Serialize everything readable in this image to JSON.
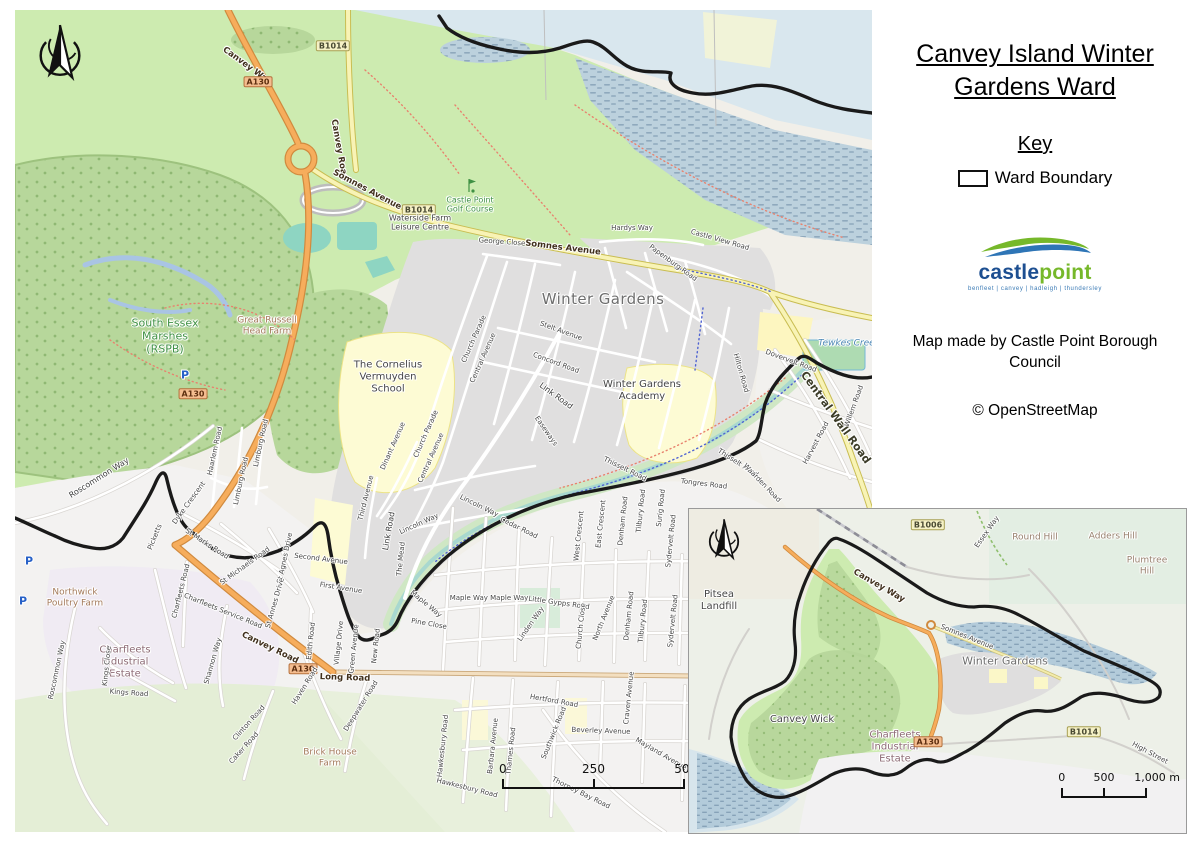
{
  "sidebar": {
    "title": "Canvey Island Winter Gardens Ward",
    "key_heading": "Key",
    "key_items": [
      {
        "symbol": "ward-boundary-rectangle",
        "label": "Ward Boundary"
      }
    ],
    "logo": {
      "brand_blue": "castle",
      "brand_green": "point",
      "tagline": "benfleet | canvey | hadleigh | thundersley",
      "color_blue": "#1d4f91",
      "color_green": "#76b82a"
    },
    "credit": "Map made by Castle Point Borough Council",
    "attribution": "© OpenStreetMap"
  },
  "colors": {
    "ward_boundary": "#1a1a1a",
    "trunk_road": "#f6ad5c",
    "secondary_road": "#f8f3b5",
    "water": "#d9e7ee",
    "greenspace": "#cdebb0",
    "residential": "#e0dfdf",
    "school": "#fdfbd4",
    "leisure": "#8ed5c2"
  },
  "main_map": {
    "north_arrow": "compass-north-arrow",
    "scalebar": {
      "start": "0",
      "mid": "250",
      "end": "500 m"
    },
    "labels": [
      {
        "text": "Canvey Way",
        "x": 232,
        "y": 56,
        "rot": 36,
        "cls": "onroad"
      },
      {
        "text": "A130",
        "x": 243,
        "y": 72,
        "cls": "a-badge"
      },
      {
        "text": "B1014",
        "x": 318,
        "y": 36,
        "cls": "b-badge"
      },
      {
        "text": "Canvey Road",
        "x": 324,
        "y": 140,
        "rot": 80,
        "cls": "onroad"
      },
      {
        "text": "Somnes Avenue",
        "x": 352,
        "y": 180,
        "rot": 28,
        "cls": "onroad"
      },
      {
        "text": "B1014",
        "x": 404,
        "y": 200,
        "cls": "b-badge"
      },
      {
        "text": "Waterside Farm\nLeisure Centre",
        "x": 405,
        "y": 213,
        "cls": "poi"
      },
      {
        "text": "Castle Point\nGolf Course",
        "x": 455,
        "y": 195,
        "cls": "green"
      },
      {
        "text": "Somnes Avenue",
        "x": 548,
        "y": 238,
        "rot": 7,
        "cls": "onroad"
      },
      {
        "text": "Hardys Way",
        "x": 617,
        "y": 218,
        "cls": "street-sm"
      },
      {
        "text": "George Close",
        "x": 487,
        "y": 232,
        "rot": 4,
        "cls": "street-sm"
      },
      {
        "text": "Castle View Road",
        "x": 705,
        "y": 230,
        "rot": 16,
        "cls": "street-sm"
      },
      {
        "text": "Papenburg Road",
        "x": 658,
        "y": 253,
        "rot": 36,
        "cls": "street-sm"
      },
      {
        "text": "Winter Gardens",
        "x": 588,
        "y": 290,
        "cls": "place"
      },
      {
        "text": "South Essex\nMarshes\n(RSPB)",
        "x": 150,
        "y": 327,
        "cls": "green-lg"
      },
      {
        "text": "Great Russell\nHead Farm",
        "x": 252,
        "y": 316,
        "cls": "farm"
      },
      {
        "text": "P",
        "x": 170,
        "y": 366,
        "cls": "parking"
      },
      {
        "text": "A130",
        "x": 178,
        "y": 384,
        "cls": "a-badge"
      },
      {
        "text": "Roscommon Way",
        "x": 84,
        "y": 468,
        "rot": -32,
        "cls": "street"
      },
      {
        "text": "Northwick\nPoultry Farm",
        "x": 60,
        "y": 588,
        "cls": "farm"
      },
      {
        "text": "P",
        "x": 14,
        "y": 552,
        "cls": "parking"
      },
      {
        "text": "P",
        "x": 8,
        "y": 592,
        "cls": "parking"
      },
      {
        "text": "The Cornelius\nVermuyden\nSchool",
        "x": 373,
        "y": 367,
        "cls": "poi-lg"
      },
      {
        "text": "Stelt Avenue",
        "x": 546,
        "y": 321,
        "rot": 20,
        "cls": "street-sm"
      },
      {
        "text": "Concord Road",
        "x": 541,
        "y": 353,
        "rot": 20,
        "cls": "street-sm"
      },
      {
        "text": "Link Road",
        "x": 541,
        "y": 386,
        "rot": 36,
        "cls": "street"
      },
      {
        "text": "Winter Gardens\nAcademy",
        "x": 627,
        "y": 381,
        "cls": "poi-lg"
      },
      {
        "text": "Easeways",
        "x": 531,
        "y": 421,
        "rot": 55,
        "cls": "street-sm"
      },
      {
        "text": "Church Parade",
        "x": 459,
        "y": 329,
        "rot": -66,
        "cls": "street-sm"
      },
      {
        "text": "Central Avenue",
        "x": 468,
        "y": 348,
        "rot": -66,
        "cls": "street-sm"
      },
      {
        "text": "Church Parade",
        "x": 411,
        "y": 424,
        "rot": -66,
        "cls": "street-sm"
      },
      {
        "text": "Central Avenue",
        "x": 416,
        "y": 448,
        "rot": -66,
        "cls": "street-sm"
      },
      {
        "text": "Dinant Avenue",
        "x": 378,
        "y": 436,
        "rot": -66,
        "cls": "street-sm"
      },
      {
        "text": "Third Avenue",
        "x": 351,
        "y": 488,
        "rot": -76,
        "cls": "street-sm"
      },
      {
        "text": "Link Road",
        "x": 374,
        "y": 521,
        "rot": -80,
        "cls": "street"
      },
      {
        "text": "Lincoln Way",
        "x": 404,
        "y": 514,
        "rot": -24,
        "cls": "street-sm"
      },
      {
        "text": "Lincoln Way",
        "x": 464,
        "y": 496,
        "rot": 26,
        "cls": "street-sm"
      },
      {
        "text": "The Mead",
        "x": 386,
        "y": 549,
        "rot": -84,
        "cls": "street-sm"
      },
      {
        "text": "Second Avenue",
        "x": 306,
        "y": 549,
        "rot": 7,
        "cls": "street-sm"
      },
      {
        "text": "First Avenue",
        "x": 326,
        "y": 578,
        "rot": 9,
        "cls": "street-sm"
      },
      {
        "text": "Hilton Road",
        "x": 726,
        "y": 363,
        "rot": 74,
        "cls": "street-sm"
      },
      {
        "text": "Tewkes Creek",
        "x": 834,
        "y": 334,
        "cls": "water"
      },
      {
        "text": "Dovervelt Road",
        "x": 776,
        "y": 351,
        "rot": 20,
        "cls": "street-sm"
      },
      {
        "text": "Central Wall Road",
        "x": 820,
        "y": 408,
        "rot": 54,
        "cls": "onroad-lg"
      },
      {
        "text": "Willem Road",
        "x": 839,
        "y": 396,
        "rot": -70,
        "cls": "street-sm"
      },
      {
        "text": "Harvest Road",
        "x": 801,
        "y": 433,
        "rot": -62,
        "cls": "street-sm"
      },
      {
        "text": "Thisselt Road",
        "x": 610,
        "y": 459,
        "rot": 26,
        "cls": "street-sm"
      },
      {
        "text": "Thisselt Road",
        "x": 723,
        "y": 453,
        "rot": 33,
        "cls": "street-sm"
      },
      {
        "text": "Waarden Road",
        "x": 747,
        "y": 473,
        "rot": 46,
        "cls": "street-sm"
      },
      {
        "text": "Tongres Road",
        "x": 689,
        "y": 474,
        "rot": 7,
        "cls": "street-sm"
      },
      {
        "text": "West Crescent",
        "x": 564,
        "y": 526,
        "rot": -84,
        "cls": "street-sm"
      },
      {
        "text": "East Crescent",
        "x": 586,
        "y": 514,
        "rot": -84,
        "cls": "street-sm"
      },
      {
        "text": "Denham Road",
        "x": 608,
        "y": 511,
        "rot": -84,
        "cls": "street-sm"
      },
      {
        "text": "Tilbury Road",
        "x": 626,
        "y": 501,
        "rot": -84,
        "cls": "street-sm"
      },
      {
        "text": "Surig Road",
        "x": 646,
        "y": 498,
        "rot": -84,
        "cls": "street-sm"
      },
      {
        "text": "Sydervelt Road",
        "x": 656,
        "y": 531,
        "rot": -84,
        "cls": "street-sm"
      },
      {
        "text": "Cedar Road",
        "x": 504,
        "y": 518,
        "rot": 26,
        "cls": "street-sm"
      },
      {
        "text": "Maple Way",
        "x": 411,
        "y": 594,
        "rot": 40,
        "cls": "street-sm"
      },
      {
        "text": "Maple Way Maple Way",
        "x": 474,
        "y": 588,
        "cls": "street-sm"
      },
      {
        "text": "Pine Close",
        "x": 414,
        "y": 614,
        "rot": 10,
        "cls": "street-sm"
      },
      {
        "text": "Little Gypps Road",
        "x": 544,
        "y": 593,
        "rot": 8,
        "cls": "street-sm"
      },
      {
        "text": "Linden Way",
        "x": 516,
        "y": 614,
        "rot": -55,
        "cls": "street-sm"
      },
      {
        "text": "Church Close",
        "x": 566,
        "y": 616,
        "rot": -84,
        "cls": "street-sm"
      },
      {
        "text": "North Avenue",
        "x": 589,
        "y": 608,
        "rot": -68,
        "cls": "street-sm"
      },
      {
        "text": "Denham Road",
        "x": 614,
        "y": 606,
        "rot": -84,
        "cls": "street-sm"
      },
      {
        "text": "Tilbury Road",
        "x": 628,
        "y": 611,
        "rot": -84,
        "cls": "street-sm"
      },
      {
        "text": "Sydervelt Road",
        "x": 658,
        "y": 611,
        "rot": -84,
        "cls": "street-sm"
      },
      {
        "text": "Craven Avenue",
        "x": 614,
        "y": 688,
        "rot": -84,
        "cls": "street-sm"
      },
      {
        "text": "Hertford Road",
        "x": 539,
        "y": 691,
        "rot": 10,
        "cls": "street-sm"
      },
      {
        "text": "Southwick Road",
        "x": 539,
        "y": 723,
        "rot": -68,
        "cls": "street-sm"
      },
      {
        "text": "Beverley Avenue",
        "x": 586,
        "y": 721,
        "rot": 2,
        "cls": "street-sm"
      },
      {
        "text": "Mayland Avenue",
        "x": 646,
        "y": 744,
        "rot": 30,
        "cls": "street-sm"
      },
      {
        "text": "Thorney Bay Road",
        "x": 566,
        "y": 783,
        "rot": 26,
        "cls": "street-sm"
      },
      {
        "text": "Hawkesbury Road",
        "x": 428,
        "y": 736,
        "rot": -84,
        "cls": "street-sm"
      },
      {
        "text": "Hawkesbury Road",
        "x": 452,
        "y": 778,
        "rot": 14,
        "cls": "street-sm"
      },
      {
        "text": "Barbara Avenue",
        "x": 478,
        "y": 736,
        "rot": -84,
        "cls": "street-sm"
      },
      {
        "text": "Thames Road",
        "x": 496,
        "y": 741,
        "rot": -84,
        "cls": "street-sm"
      },
      {
        "text": "Charfleets\nIndustrial\nEstate",
        "x": 110,
        "y": 652,
        "cls": "estate"
      },
      {
        "text": "Charfleets Road",
        "x": 166,
        "y": 581,
        "rot": -76,
        "cls": "street-sm"
      },
      {
        "text": "Charfleets Service Road",
        "x": 208,
        "y": 601,
        "rot": 22,
        "cls": "street-sm"
      },
      {
        "text": "Canvey Road",
        "x": 255,
        "y": 638,
        "rot": 26,
        "cls": "onroad"
      },
      {
        "text": "A130",
        "x": 288,
        "y": 659,
        "cls": "a-badge"
      },
      {
        "text": "Long Road",
        "x": 330,
        "y": 668,
        "rot": 2,
        "cls": "onroad"
      },
      {
        "text": "Shannon Way",
        "x": 198,
        "y": 651,
        "rot": -74,
        "cls": "street-sm"
      },
      {
        "text": "Kings Close",
        "x": 92,
        "y": 656,
        "rot": -84,
        "cls": "street-sm"
      },
      {
        "text": "Kings Road",
        "x": 114,
        "y": 683,
        "rot": 4,
        "cls": "street-sm"
      },
      {
        "text": "Roscommon Way",
        "x": 42,
        "y": 660,
        "rot": -78,
        "cls": "street-sm"
      },
      {
        "text": "St Marks Road",
        "x": 192,
        "y": 534,
        "rot": 33,
        "cls": "street-sm"
      },
      {
        "text": "Picketts",
        "x": 140,
        "y": 527,
        "rot": -68,
        "cls": "street-sm"
      },
      {
        "text": "St Michaels Road",
        "x": 230,
        "y": 556,
        "rot": -36,
        "cls": "street-sm"
      },
      {
        "text": "St Agnes Drive",
        "x": 270,
        "y": 548,
        "rot": -78,
        "cls": "street-sm"
      },
      {
        "text": "St Annes Drive",
        "x": 260,
        "y": 593,
        "rot": -74,
        "cls": "street-sm"
      },
      {
        "text": "Edith Road",
        "x": 296,
        "y": 631,
        "rot": -84,
        "cls": "street-sm"
      },
      {
        "text": "Haven Road",
        "x": 290,
        "y": 676,
        "rot": -58,
        "cls": "street-sm"
      },
      {
        "text": "Village Drive",
        "x": 324,
        "y": 633,
        "rot": -84,
        "cls": "street-sm"
      },
      {
        "text": "Green Avenue",
        "x": 339,
        "y": 639,
        "rot": -84,
        "cls": "street-sm"
      },
      {
        "text": "New Road",
        "x": 361,
        "y": 636,
        "rot": -84,
        "cls": "street-sm"
      },
      {
        "text": "Deepwater Road",
        "x": 346,
        "y": 696,
        "rot": -58,
        "cls": "street-sm"
      },
      {
        "text": "Clinton Road",
        "x": 234,
        "y": 713,
        "rot": -48,
        "cls": "street-sm"
      },
      {
        "text": "Caker Road",
        "x": 229,
        "y": 738,
        "rot": -48,
        "cls": "street-sm"
      },
      {
        "text": "Brick House\nFarm",
        "x": 315,
        "y": 748,
        "cls": "farm"
      },
      {
        "text": "Dyke Crescent",
        "x": 174,
        "y": 493,
        "rot": -54,
        "cls": "street-sm"
      },
      {
        "text": "Haarlem Road",
        "x": 200,
        "y": 441,
        "rot": -78,
        "cls": "street-sm"
      },
      {
        "text": "Limburg Road",
        "x": 226,
        "y": 471,
        "rot": -78,
        "cls": "street-sm"
      },
      {
        "text": "Limburg Road",
        "x": 246,
        "y": 433,
        "rot": -78,
        "cls": "street-sm"
      }
    ]
  },
  "inset_map": {
    "north_arrow": "compass-north-arrow",
    "scalebar": {
      "start": "0",
      "mid": "500",
      "end": "1,000 m"
    },
    "labels": [
      {
        "text": "B1006",
        "x": 239,
        "y": 16,
        "cls": "b-badge"
      },
      {
        "text": "Essex Way",
        "x": 298,
        "y": 23,
        "rot": -55,
        "cls": "street-sm"
      },
      {
        "text": "Round Hill",
        "x": 346,
        "y": 29,
        "cls": "hill"
      },
      {
        "text": "Adders Hill",
        "x": 424,
        "y": 28,
        "cls": "hill"
      },
      {
        "text": "Plumtree\nHill",
        "x": 458,
        "y": 57,
        "cls": "hill"
      },
      {
        "text": "Pitsea\nLandfill",
        "x": 30,
        "y": 92,
        "cls": "poi-lg"
      },
      {
        "text": "Canvey Way",
        "x": 190,
        "y": 77,
        "rot": 30,
        "cls": "onroad"
      },
      {
        "text": "Somnes Avenue",
        "x": 278,
        "y": 128,
        "rot": 22,
        "cls": "street-sm"
      },
      {
        "text": "Winter Gardens",
        "x": 316,
        "y": 153,
        "cls": "place-sm"
      },
      {
        "text": "Canvey Wick",
        "x": 113,
        "y": 211,
        "cls": "poi-lg"
      },
      {
        "text": "Charfleets\nIndustrial\nEstate",
        "x": 206,
        "y": 238,
        "cls": "estate"
      },
      {
        "text": "A130",
        "x": 239,
        "y": 233,
        "cls": "a-badge"
      },
      {
        "text": "B1014",
        "x": 395,
        "y": 223,
        "cls": "b-badge"
      },
      {
        "text": "High Street",
        "x": 461,
        "y": 244,
        "rot": 28,
        "cls": "street-sm"
      }
    ]
  }
}
